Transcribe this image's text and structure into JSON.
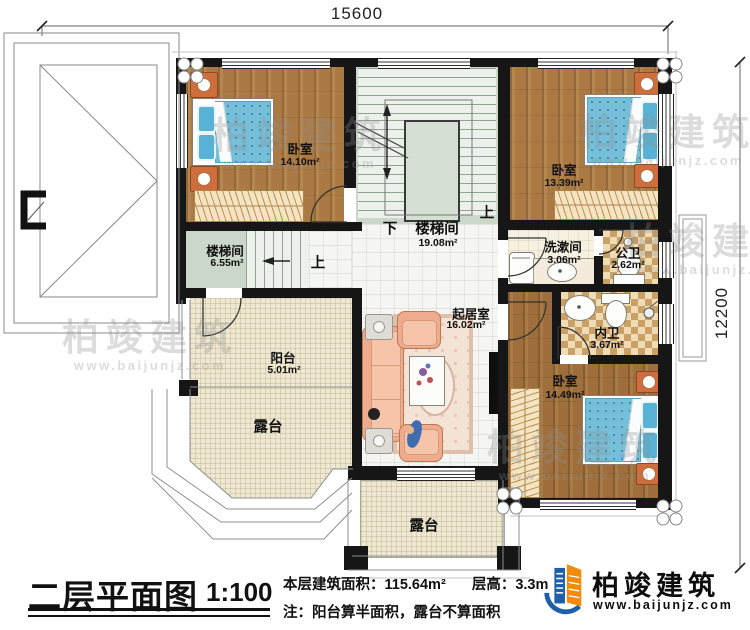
{
  "dimensions": {
    "horizontal": "15600",
    "vertical": "12200"
  },
  "rooms": {
    "bedroom1": {
      "name": "卧室",
      "area": "14.10m²"
    },
    "bedroom2": {
      "name": "卧室",
      "area": "13.39m²"
    },
    "bedroom3": {
      "name": "卧室",
      "area": "14.49m²"
    },
    "stair_main": {
      "name": "楼梯间",
      "area": "19.08m²"
    },
    "stair_left": {
      "name": "楼梯间",
      "area": "6.55m²"
    },
    "washroom": {
      "name": "洗漱间",
      "area": "3.06m²"
    },
    "public_bath": {
      "name": "公卫",
      "area": "2.62m²"
    },
    "private_bath": {
      "name": "内卫",
      "area": "3.67m²"
    },
    "living": {
      "name": "起居室",
      "area": "16.02m²"
    },
    "balcony": {
      "name": "阳台",
      "area": "5.01m²"
    },
    "terrace_left": {
      "name": "露台"
    },
    "terrace_bottom": {
      "name": "露台"
    }
  },
  "stairs": {
    "up": "上",
    "down": "下"
  },
  "title_block": {
    "title": "二层平面图",
    "scale": "1:100",
    "area_label": "本层建筑面积：",
    "area_value": "115.64m²",
    "height_label": "层高：",
    "height_value": "3.3m",
    "note": "注：阳台算半面积，露台不算面积"
  },
  "brand": {
    "name": "柏竣建筑",
    "url": "www.baijunjz.com"
  },
  "colors": {
    "wall": "#161616",
    "wood_floor": "#ab7a44",
    "stair_floor": "#ccd7cb",
    "tile_beige": "#eee8d1",
    "bath_tile": "#c9a066",
    "bed_blue": "#76bfd9",
    "sofa_peach": "#efab8d",
    "brand_blue": "#1d5fa8",
    "brand_orange": "#f28a0e"
  }
}
